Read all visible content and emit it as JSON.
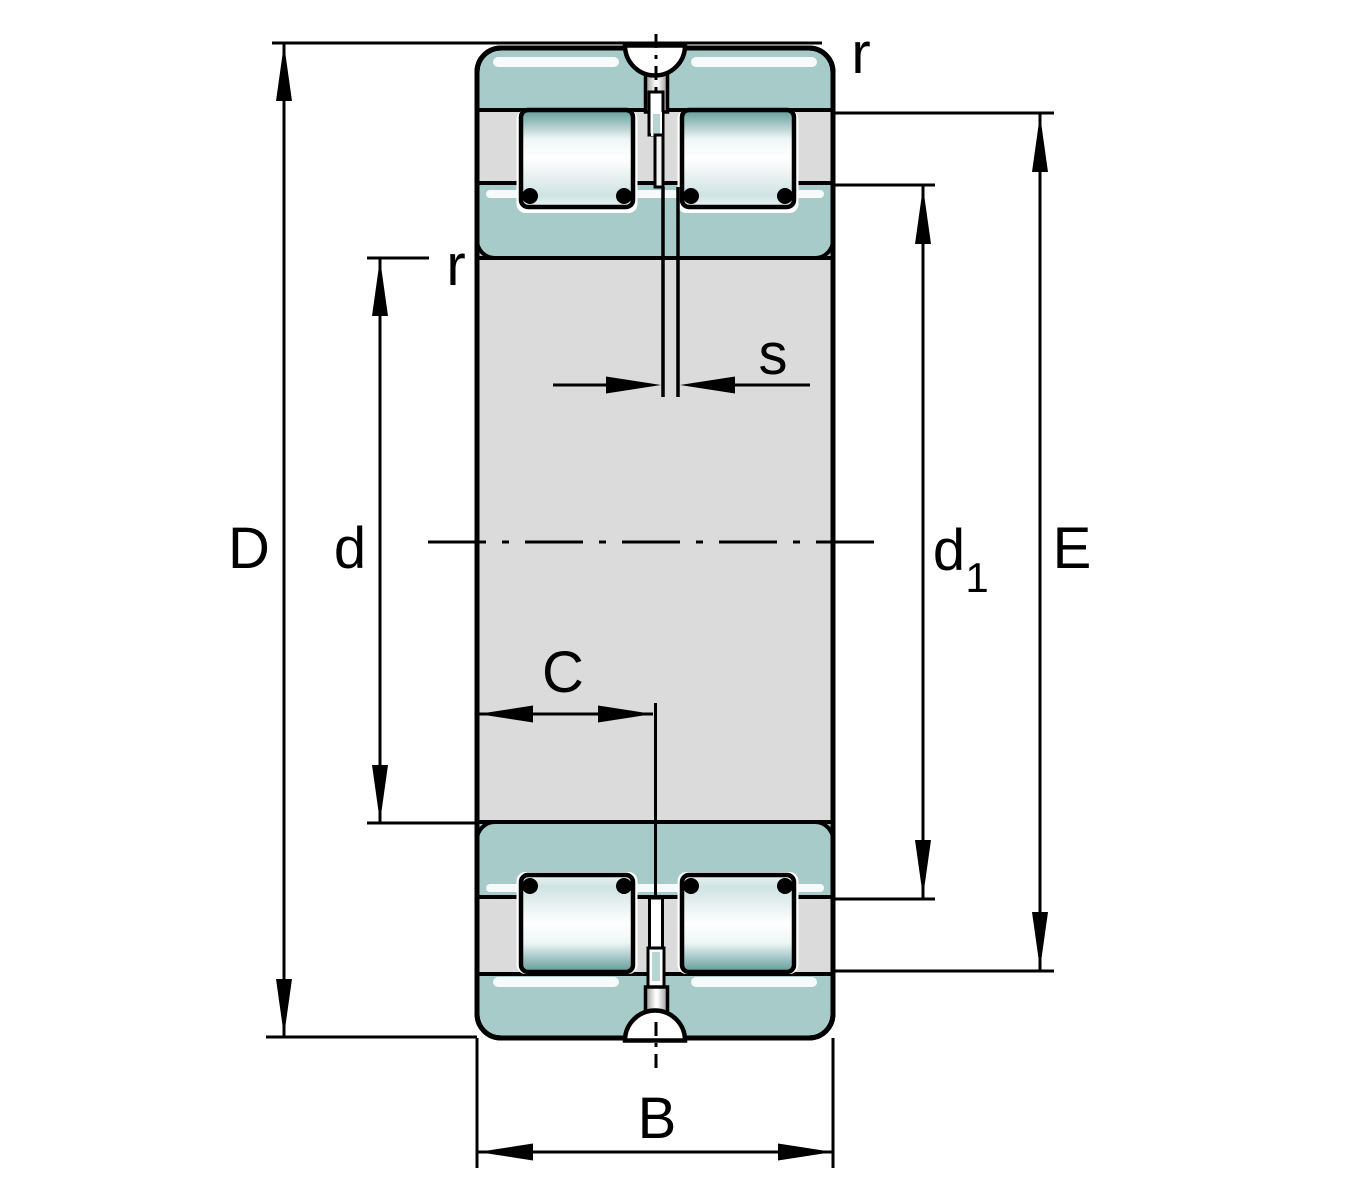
{
  "figure": {
    "type": "bearing-cross-section-drawing",
    "subject": "Double-row full complement cylindrical roller bearing, sectional drawing with dimension symbols",
    "labels": {
      "D": "D",
      "d": "d",
      "d1_base": "d",
      "d1_sub": "1",
      "E": "E",
      "B": "B",
      "C": "C",
      "s": "s",
      "r_bore": "r",
      "r_outer": "r"
    },
    "colors": {
      "ring_fill": "#a6cbc9",
      "pocket_fill": "#b7d5d3",
      "section_grey": "#dbdbdb",
      "roller_teal_dark": "#5f9a98",
      "highlight_white": "#ffffff",
      "line_black": "#000000",
      "background": "#ffffff"
    }
  }
}
